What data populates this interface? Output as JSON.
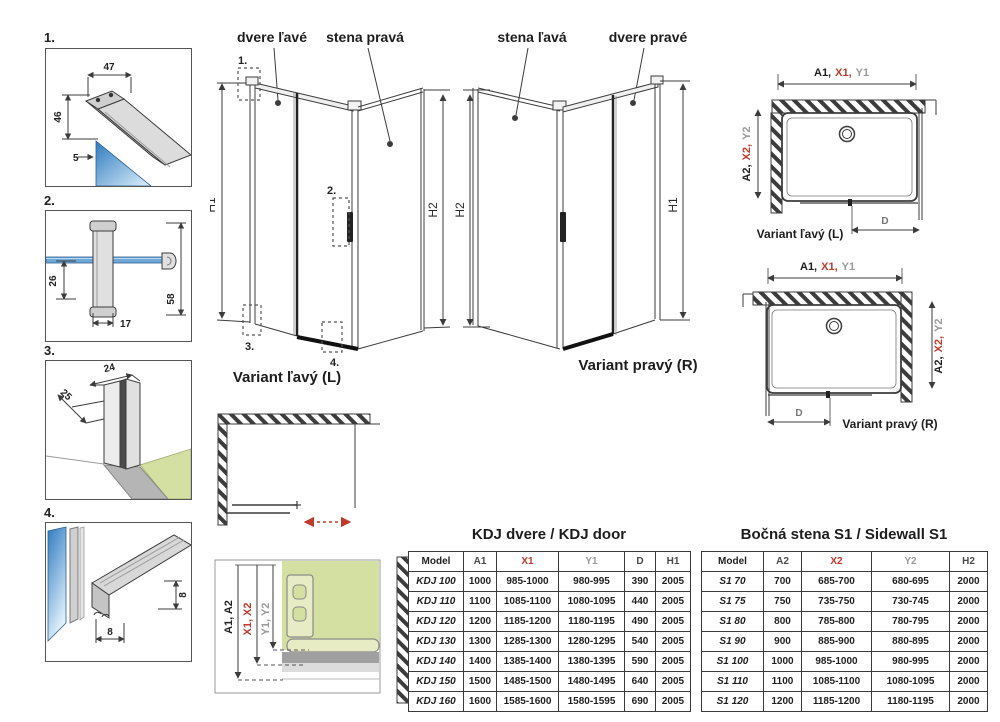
{
  "colors": {
    "line": "#3c3c3c",
    "accent_red": "#c0392b",
    "dim_gray": "#9a9a9a",
    "glass_blue_dark": "#2e7bc0",
    "glass_blue_light": "#dff0fb",
    "floor_green": "#d4dfa2",
    "profile_gray": "#d6d6d6"
  },
  "details": {
    "d1": {
      "num": "1.",
      "dim_top": "47",
      "dim_side": "46",
      "dim_glass": "5"
    },
    "d2": {
      "num": "2.",
      "dim_offset": "26",
      "dim_width": "17",
      "dim_height": "58"
    },
    "d3": {
      "num": "3.",
      "dim_depth": "25",
      "dim_width": "24"
    },
    "d4": {
      "num": "4.",
      "dim_width": "8",
      "dim_height": "8"
    }
  },
  "isometric": {
    "left": {
      "door_label": "dvere ľavé",
      "wall_label": "stena pravá",
      "caption": "Variant ľavý (L)",
      "dim_left": "H1",
      "dim_right": "H2",
      "c1": "1.",
      "c2": "2.",
      "c3": "3.",
      "c4": "4."
    },
    "right": {
      "wall_label": "stena ľavá",
      "door_label": "dvere pravé",
      "caption": "Variant pravý (R)",
      "dim_left": "H2",
      "dim_right": "H1"
    }
  },
  "plans": {
    "left": {
      "caption": "Variant ľavý (L)",
      "dim_a": "A1,",
      "dim_x": "X1,",
      "dim_y": "Y1",
      "side_a": "A2,",
      "side_x": "X2,",
      "side_y": "Y2",
      "door_dim": "D"
    },
    "right": {
      "caption": "Variant pravý (R)",
      "dim_a": "A1,",
      "dim_x": "X1,",
      "dim_y": "Y1",
      "side_a": "A2,",
      "side_x": "X2,",
      "side_y": "Y2",
      "door_dim": "D"
    }
  },
  "adjust_detail": {
    "a": "A1, A2",
    "x": "X1, X2",
    "y": "Y1, Y2"
  },
  "tables": {
    "kdj": {
      "title": "KDJ dvere / KDJ door",
      "headers": [
        {
          "label": "Model",
          "color": "#1f1f1f"
        },
        {
          "label": "A1",
          "color": "#4a4a4a"
        },
        {
          "label": "X1",
          "color": "#c0392b"
        },
        {
          "label": "Y1",
          "color": "#9a9a9a"
        },
        {
          "label": "D",
          "color": "#4a4a4a"
        },
        {
          "label": "H1",
          "color": "#4a4a4a"
        }
      ],
      "rows": [
        [
          "KDJ 100",
          "1000",
          "985-1000",
          "980-995",
          "390",
          "2005"
        ],
        [
          "KDJ 110",
          "1100",
          "1085-1100",
          "1080-1095",
          "440",
          "2005"
        ],
        [
          "KDJ 120",
          "1200",
          "1185-1200",
          "1180-1195",
          "490",
          "2005"
        ],
        [
          "KDJ 130",
          "1300",
          "1285-1300",
          "1280-1295",
          "540",
          "2005"
        ],
        [
          "KDJ 140",
          "1400",
          "1385-1400",
          "1380-1395",
          "590",
          "2005"
        ],
        [
          "KDJ 150",
          "1500",
          "1485-1500",
          "1480-1495",
          "640",
          "2005"
        ],
        [
          "KDJ 160",
          "1600",
          "1585-1600",
          "1580-1595",
          "690",
          "2005"
        ]
      ]
    },
    "s1": {
      "title": "Bočná stena S1 / Sidewall S1",
      "headers": [
        {
          "label": "Model",
          "color": "#1f1f1f"
        },
        {
          "label": "A2",
          "color": "#4a4a4a"
        },
        {
          "label": "X2",
          "color": "#c0392b"
        },
        {
          "label": "Y2",
          "color": "#9a9a9a"
        },
        {
          "label": "H2",
          "color": "#4a4a4a"
        }
      ],
      "rows": [
        [
          "S1 70",
          "700",
          "685-700",
          "680-695",
          "2000"
        ],
        [
          "S1 75",
          "750",
          "735-750",
          "730-745",
          "2000"
        ],
        [
          "S1 80",
          "800",
          "785-800",
          "780-795",
          "2000"
        ],
        [
          "S1 90",
          "900",
          "885-900",
          "880-895",
          "2000"
        ],
        [
          "S1 100",
          "1000",
          "985-1000",
          "980-995",
          "2000"
        ],
        [
          "S1 110",
          "1100",
          "1085-1100",
          "1080-1095",
          "2000"
        ],
        [
          "S1 120",
          "1200",
          "1185-1200",
          "1180-1195",
          "2000"
        ]
      ]
    }
  }
}
